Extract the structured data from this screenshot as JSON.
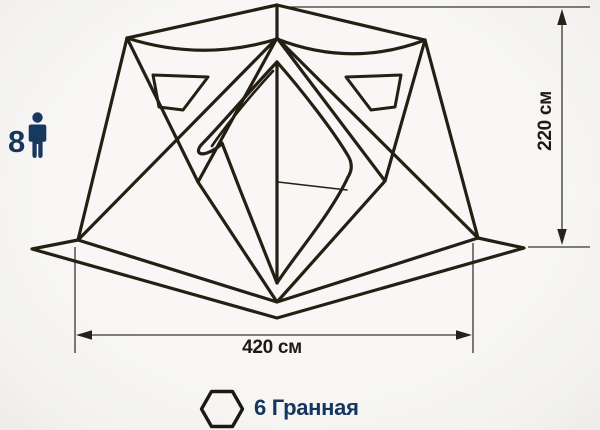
{
  "canvas": {
    "background": "#f7f6f4",
    "line_color": "#251f13",
    "dimension_line_color": "#3a352b",
    "dimension_text_color": "#201a12",
    "accent_color": "#16365c"
  },
  "capacity": {
    "count": "8",
    "icon": "person-icon"
  },
  "dimensions": {
    "height_label": "220 см",
    "width_label": "420 см"
  },
  "shape": {
    "label": "6 Гранная",
    "icon": "hexagon-icon"
  },
  "subject": {
    "type": "hexagonal pop-up tent line drawing",
    "windows_visible": 2,
    "door_visible": 1
  }
}
